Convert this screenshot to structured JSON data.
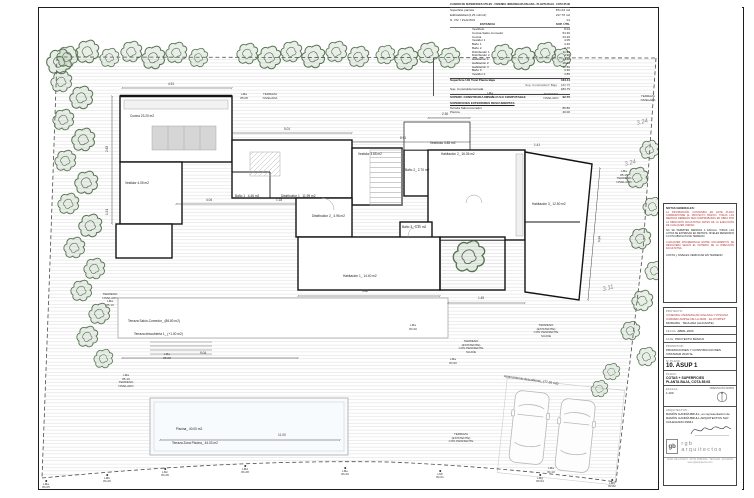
{
  "area_table": {
    "title": "CUADRO DE SUPERFICIES ÚTILES · VIVIENDA UNIFAMILIAR AISLADA · PLANTA BAJA · COTA 85.08 · MORAIRA",
    "meta": [
      {
        "label": "Superficie parcela",
        "value": "871.04 m2"
      },
      {
        "label": "Edificabilidad (0,25 m2/m2)",
        "value": "217.76 m2"
      },
      {
        "label": "N. VIV. / PLANTAS",
        "value": "01"
      }
    ],
    "col_header": {
      "name": "ESTANCIA",
      "value": "SUP. ÚTIL"
    },
    "rows": [
      {
        "name": "Vestíbulo",
        "value": "8.04"
      },
      {
        "name": "Cocina-Salón-Comedor",
        "value": "54.30"
      },
      {
        "name": "Cocina",
        "value": "23.20"
      },
      {
        "name": "Vestidor 1",
        "value": "4.05"
      },
      {
        "name": "Baño 1",
        "value": "4.46"
      },
      {
        "name": "Baño 2",
        "value": "2.70"
      },
      {
        "name": "Distribuidor 1",
        "value": "11.99"
      },
      {
        "name": "Distribuidor 2",
        "value": "4.96"
      },
      {
        "name": "Habitación 1",
        "value": "14.40"
      },
      {
        "name": "Habitación 2",
        "value": "16.36"
      },
      {
        "name": "Habitación 3",
        "value": "12.50"
      },
      {
        "name": "Baño 3",
        "value": "3.30"
      },
      {
        "name": "Vestidor 2",
        "value": "3.85"
      }
    ],
    "total": {
      "label": "Superficie Útil Total Planta Baja",
      "value": "164.11"
    },
    "constructed_note": {
      "label": "Sup. Construida P. Baja",
      "value": "183.75"
    },
    "constructed": {
      "label": "Sup. Construida Cerrada",
      "value": "183.75"
    },
    "computable": {
      "label": "SUPERF. CONSTRUIDA DE CÁLCULO COMPUTABLE",
      "value": "92.75"
    },
    "exterior_title": "SUPERFICIES EXTERIORES DESCUBIERTAS",
    "exterior_rows": [
      {
        "name": "Terraza Salón-Comedor",
        "value": "86.80"
      },
      {
        "name": "Piscina",
        "value": "40.00"
      }
    ]
  },
  "title_block": {
    "notes_title": "NOTAS GENERALES:",
    "notes_red_1": "LA INFORMACIÓN CONTENIDA EN ESTE PLANO CORRESPONDE AL PROYECTO BÁSICO. TODAS LAS MEDIDAS DEBERÁN SER COMPROBADAS EN OBRA POR LA DIRECCIÓN FACULTATIVA ANTES DE LA EJECUCIÓN DE CUALQUIER UNIDAD.",
    "notes_black": "NO SE PERMITEN MEDIDAS A ESCALA. TODAS LAS COTAS SE EXPRESAN EN METROS. NIVELES REFERIDOS A COTA ABSOLUTA DE TERRENO.",
    "notes_red_2": "CUALQUIER DISCREPANCIA ENTRE DOCUMENTOS SE RESOLVERÁ SEGÚN EL CRITERIO DE LA DIRECCIÓN FACULTATIVA.",
    "notes_footer": "COTAS y NIVELES VERIFICAR EN TERRENO",
    "project_label": "PROYECTO:",
    "project_lines": [
      "VIVIENDA UNIFAMILIAR AISLADA Y PISCINA",
      "CARRER AMPLE DE LA MAR · EL PORTET",
      "MORAIRA · TEULADA (ALICANTE)"
    ],
    "date_label": "FECHA:",
    "date_value": "ABRIL 2020",
    "phase_label": "FASE:",
    "phase_value": "PROYECTO BÁSICO",
    "client_label": "PROMOTOR:",
    "client_value": "PROMOCIONES Y CONSTRUCCIONES VISTAMAR 2019 SL",
    "number_label": "Nº PLANO:",
    "number_value": "10. ASUP 1",
    "plan_label": "PLANO:",
    "plan_lines": [
      "COTAS + SUPERFICIES",
      "PLANTA BAJA, COTA 85.08"
    ],
    "scale_label": "ESCALA:",
    "scale_value": "1:100",
    "orientation_label": "ORIENTACIÓN NORTE",
    "architect_label": "ARQUITECTOS:",
    "architect_lines": [
      "RAMÓN GANDÍA BRULL, en representación de",
      "RAMÓN GANDÍA BRULL ARQUITECTOS SLP",
      "COLEGIADO 09941"
    ],
    "logo_glyph": "gb",
    "studio_name": "rgb arquitectos",
    "footer_line_1": "AVDA. DE LA PAZ 5 · 03724 MORAIRA · TEULADA · ALICANTE",
    "footer_line_2": "www.rgbarquitectos.com"
  },
  "plan": {
    "room_labels": [
      {
        "text": "Cocina 23.20 m2",
        "x": 130,
        "y": 115
      },
      {
        "text": "Vestidor 4.05 m2",
        "x": 125,
        "y": 182
      },
      {
        "text": "Baño 1_ 4.46 m2",
        "x": 235,
        "y": 195
      },
      {
        "text": "Distribuidor 1_ 11.99 m2",
        "x": 281,
        "y": 195
      },
      {
        "text": "Vestidor 3.85 m2",
        "x": 358,
        "y": 153
      },
      {
        "text": "Distribuidor 2_ 4.96 m2",
        "x": 312,
        "y": 215
      },
      {
        "text": "Vestíbulo 3.85 m2",
        "x": 430,
        "y": 142
      },
      {
        "text": "Habitación 2_ 16.36 m2",
        "x": 441,
        "y": 153
      },
      {
        "text": "Baño 2_ 2.70 m2",
        "x": 405,
        "y": 169
      },
      {
        "text": "Baño 3_ 3.30 m2",
        "x": 402,
        "y": 226
      },
      {
        "text": "Habitación 1_ 14.40 m2",
        "x": 343,
        "y": 275
      },
      {
        "text": "Habitación 3_ 12.50 m2",
        "x": 532,
        "y": 203
      },
      {
        "text": "Terraza Salón-Comedor_ (86.80 m2)",
        "x": 128,
        "y": 320
      },
      {
        "text": "Terraza descubierta 1_ (+1.00 m2)",
        "x": 134,
        "y": 333
      },
      {
        "text": "Piscina_ 40.00 m2",
        "x": 176,
        "y": 428
      },
      {
        "text": "Terraza Zona Piscina_ 44.03 m2",
        "x": 172,
        "y": 442
      },
      {
        "text": "Aparcamiento descubierto_ (77.20 m2)",
        "x": 504,
        "y": 375,
        "rot": 8
      }
    ],
    "dim_labels": [
      {
        "text": "4.51",
        "x": 168,
        "y": 83
      },
      {
        "text": "5.01",
        "x": 284,
        "y": 128
      },
      {
        "text": "8.91",
        "x": 400,
        "y": 137
      },
      {
        "text": "2.30",
        "x": 442,
        "y": 113
      },
      {
        "text": "2.63",
        "x": 106,
        "y": 152,
        "rot": -90
      },
      {
        "text": "1.91",
        "x": 106,
        "y": 215,
        "rot": -90
      },
      {
        "text": "6.84",
        "x": 598,
        "y": 242,
        "rot": -85
      },
      {
        "text": "5.82",
        "x": 362,
        "y": 290
      },
      {
        "text": "1.45",
        "x": 478,
        "y": 297
      },
      {
        "text": "9.04",
        "x": 200,
        "y": 352
      },
      {
        "text": "11.00",
        "x": 278,
        "y": 434
      },
      {
        "text": "1.41",
        "x": 534,
        "y": 144
      },
      {
        "text": "4.04",
        "x": 206,
        "y": 199
      },
      {
        "text": "1.18",
        "x": 276,
        "y": 199
      },
      {
        "text": "3.24",
        "x": 636,
        "y": 121,
        "cls": "slope",
        "rot": -14
      },
      {
        "text": "3.24",
        "x": 624,
        "y": 162,
        "cls": "slope",
        "rot": -14
      },
      {
        "text": "3.11",
        "x": 602,
        "y": 287,
        "cls": "slope",
        "rot": -14
      }
    ],
    "terrain_labels": [
      {
        "lines": [
          "LMa",
          "85.08"
        ],
        "x": 244,
        "y": 93
      },
      {
        "lines": [
          "TERRAZA",
          "NIVELADA"
        ],
        "x": 270,
        "y": 93
      },
      {
        "lines": [
          "LMa",
          "85.15"
        ],
        "x": 490,
        "y": 92
      },
      {
        "lines": [
          "TERRENO",
          "NIVELADO"
        ],
        "x": 551,
        "y": 93
      },
      {
        "lines": [
          "TERRAZA",
          "NIVELADA"
        ],
        "x": 648,
        "y": 95
      },
      {
        "lines": [
          "LMa",
          "85.15",
          "TERRENO",
          "NIVELADO"
        ],
        "x": 624,
        "y": 170
      },
      {
        "lines": [
          "TERRENO",
          "NIVELADO",
          "LMa",
          "85.10"
        ],
        "x": 110,
        "y": 293
      },
      {
        "lines": [
          "LMa",
          "85.10",
          "TERRENO",
          "NIVELADO"
        ],
        "x": 126,
        "y": 374
      },
      {
        "lines": [
          "LMa",
          "85.08"
        ],
        "x": 167,
        "y": 353
      },
      {
        "lines": [
          "LMa",
          "84.30"
        ],
        "x": 413,
        "y": 324
      },
      {
        "lines": [
          "LMa",
          "84.90"
        ],
        "x": 453,
        "y": 358
      },
      {
        "lines": [
          "TERRENO",
          "(EXISTENTE)",
          "CON PENDIENTE",
          "SUAVE"
        ],
        "x": 546,
        "y": 324
      },
      {
        "lines": [
          "TERRENO",
          "(EXISTENTE)",
          "CON PENDIENTE",
          "SUAVE"
        ],
        "x": 471,
        "y": 340
      },
      {
        "lines": [
          "TERRAZA",
          "(EXISTENTE)",
          "CON PENDIENTE"
        ],
        "x": 461,
        "y": 433
      },
      {
        "lines": [
          "LMa",
          "84.10"
        ],
        "x": 551,
        "y": 467
      }
    ],
    "survey_points": [
      {
        "code": "LMa",
        "value": "84.05",
        "x": 46,
        "y": 480
      },
      {
        "code": "LMb",
        "value": "84.26",
        "x": 107,
        "y": 474
      },
      {
        "code": "LMc",
        "value": "84.28",
        "x": 165,
        "y": 468
      },
      {
        "code": "LMd",
        "value": "84.28",
        "x": 245,
        "y": 465
      },
      {
        "code": "LMe",
        "value": "84.26",
        "x": 345,
        "y": 467
      },
      {
        "code": "LMf",
        "value": "84.01",
        "x": 440,
        "y": 470
      },
      {
        "code": "LMg",
        "value": "83.94",
        "x": 540,
        "y": 474
      },
      {
        "code": "LMh",
        "value": "83.82",
        "x": 612,
        "y": 479
      }
    ],
    "trees": [
      [
        60,
        62,
        1.2
      ],
      [
        68,
        57,
        1
      ],
      [
        88,
        52,
        1.1
      ],
      [
        110,
        58,
        0.9
      ],
      [
        132,
        52,
        1
      ],
      [
        154,
        58,
        1.1
      ],
      [
        177,
        53,
        1
      ],
      [
        199,
        58,
        0.9
      ],
      [
        248,
        54,
        1
      ],
      [
        270,
        58,
        1.1
      ],
      [
        292,
        52,
        1
      ],
      [
        314,
        57,
        1.1
      ],
      [
        337,
        52,
        1
      ],
      [
        359,
        57,
        1
      ],
      [
        386,
        55,
        0.9
      ],
      [
        407,
        59,
        1.1
      ],
      [
        429,
        53,
        1
      ],
      [
        450,
        58,
        1
      ],
      [
        503,
        55,
        1
      ],
      [
        524,
        59,
        1.1
      ],
      [
        546,
        53,
        1
      ],
      [
        562,
        58,
        0.9
      ],
      [
        62,
        82,
        1
      ],
      [
        82,
        98,
        1.1
      ],
      [
        64,
        120,
        1
      ],
      [
        84,
        140,
        1.1
      ],
      [
        66,
        161,
        1
      ],
      [
        87,
        183,
        1.1
      ],
      [
        69,
        204,
        1
      ],
      [
        91,
        226,
        1.1
      ],
      [
        75,
        248,
        1
      ],
      [
        95,
        269,
        1
      ],
      [
        82,
        291,
        1
      ],
      [
        100,
        314,
        1
      ],
      [
        88,
        337,
        1
      ],
      [
        104,
        359,
        0.9
      ],
      [
        650,
        150,
        0.9
      ],
      [
        638,
        178,
        1
      ],
      [
        653,
        207,
        0.9
      ],
      [
        641,
        239,
        1
      ],
      [
        655,
        271,
        0.9
      ],
      [
        643,
        301,
        1
      ],
      [
        631,
        331,
        0.9
      ],
      [
        647,
        357,
        0.9
      ],
      [
        612,
        372,
        0.8
      ],
      [
        600,
        389,
        0.8
      ],
      [
        470,
        257,
        1.5
      ]
    ]
  }
}
